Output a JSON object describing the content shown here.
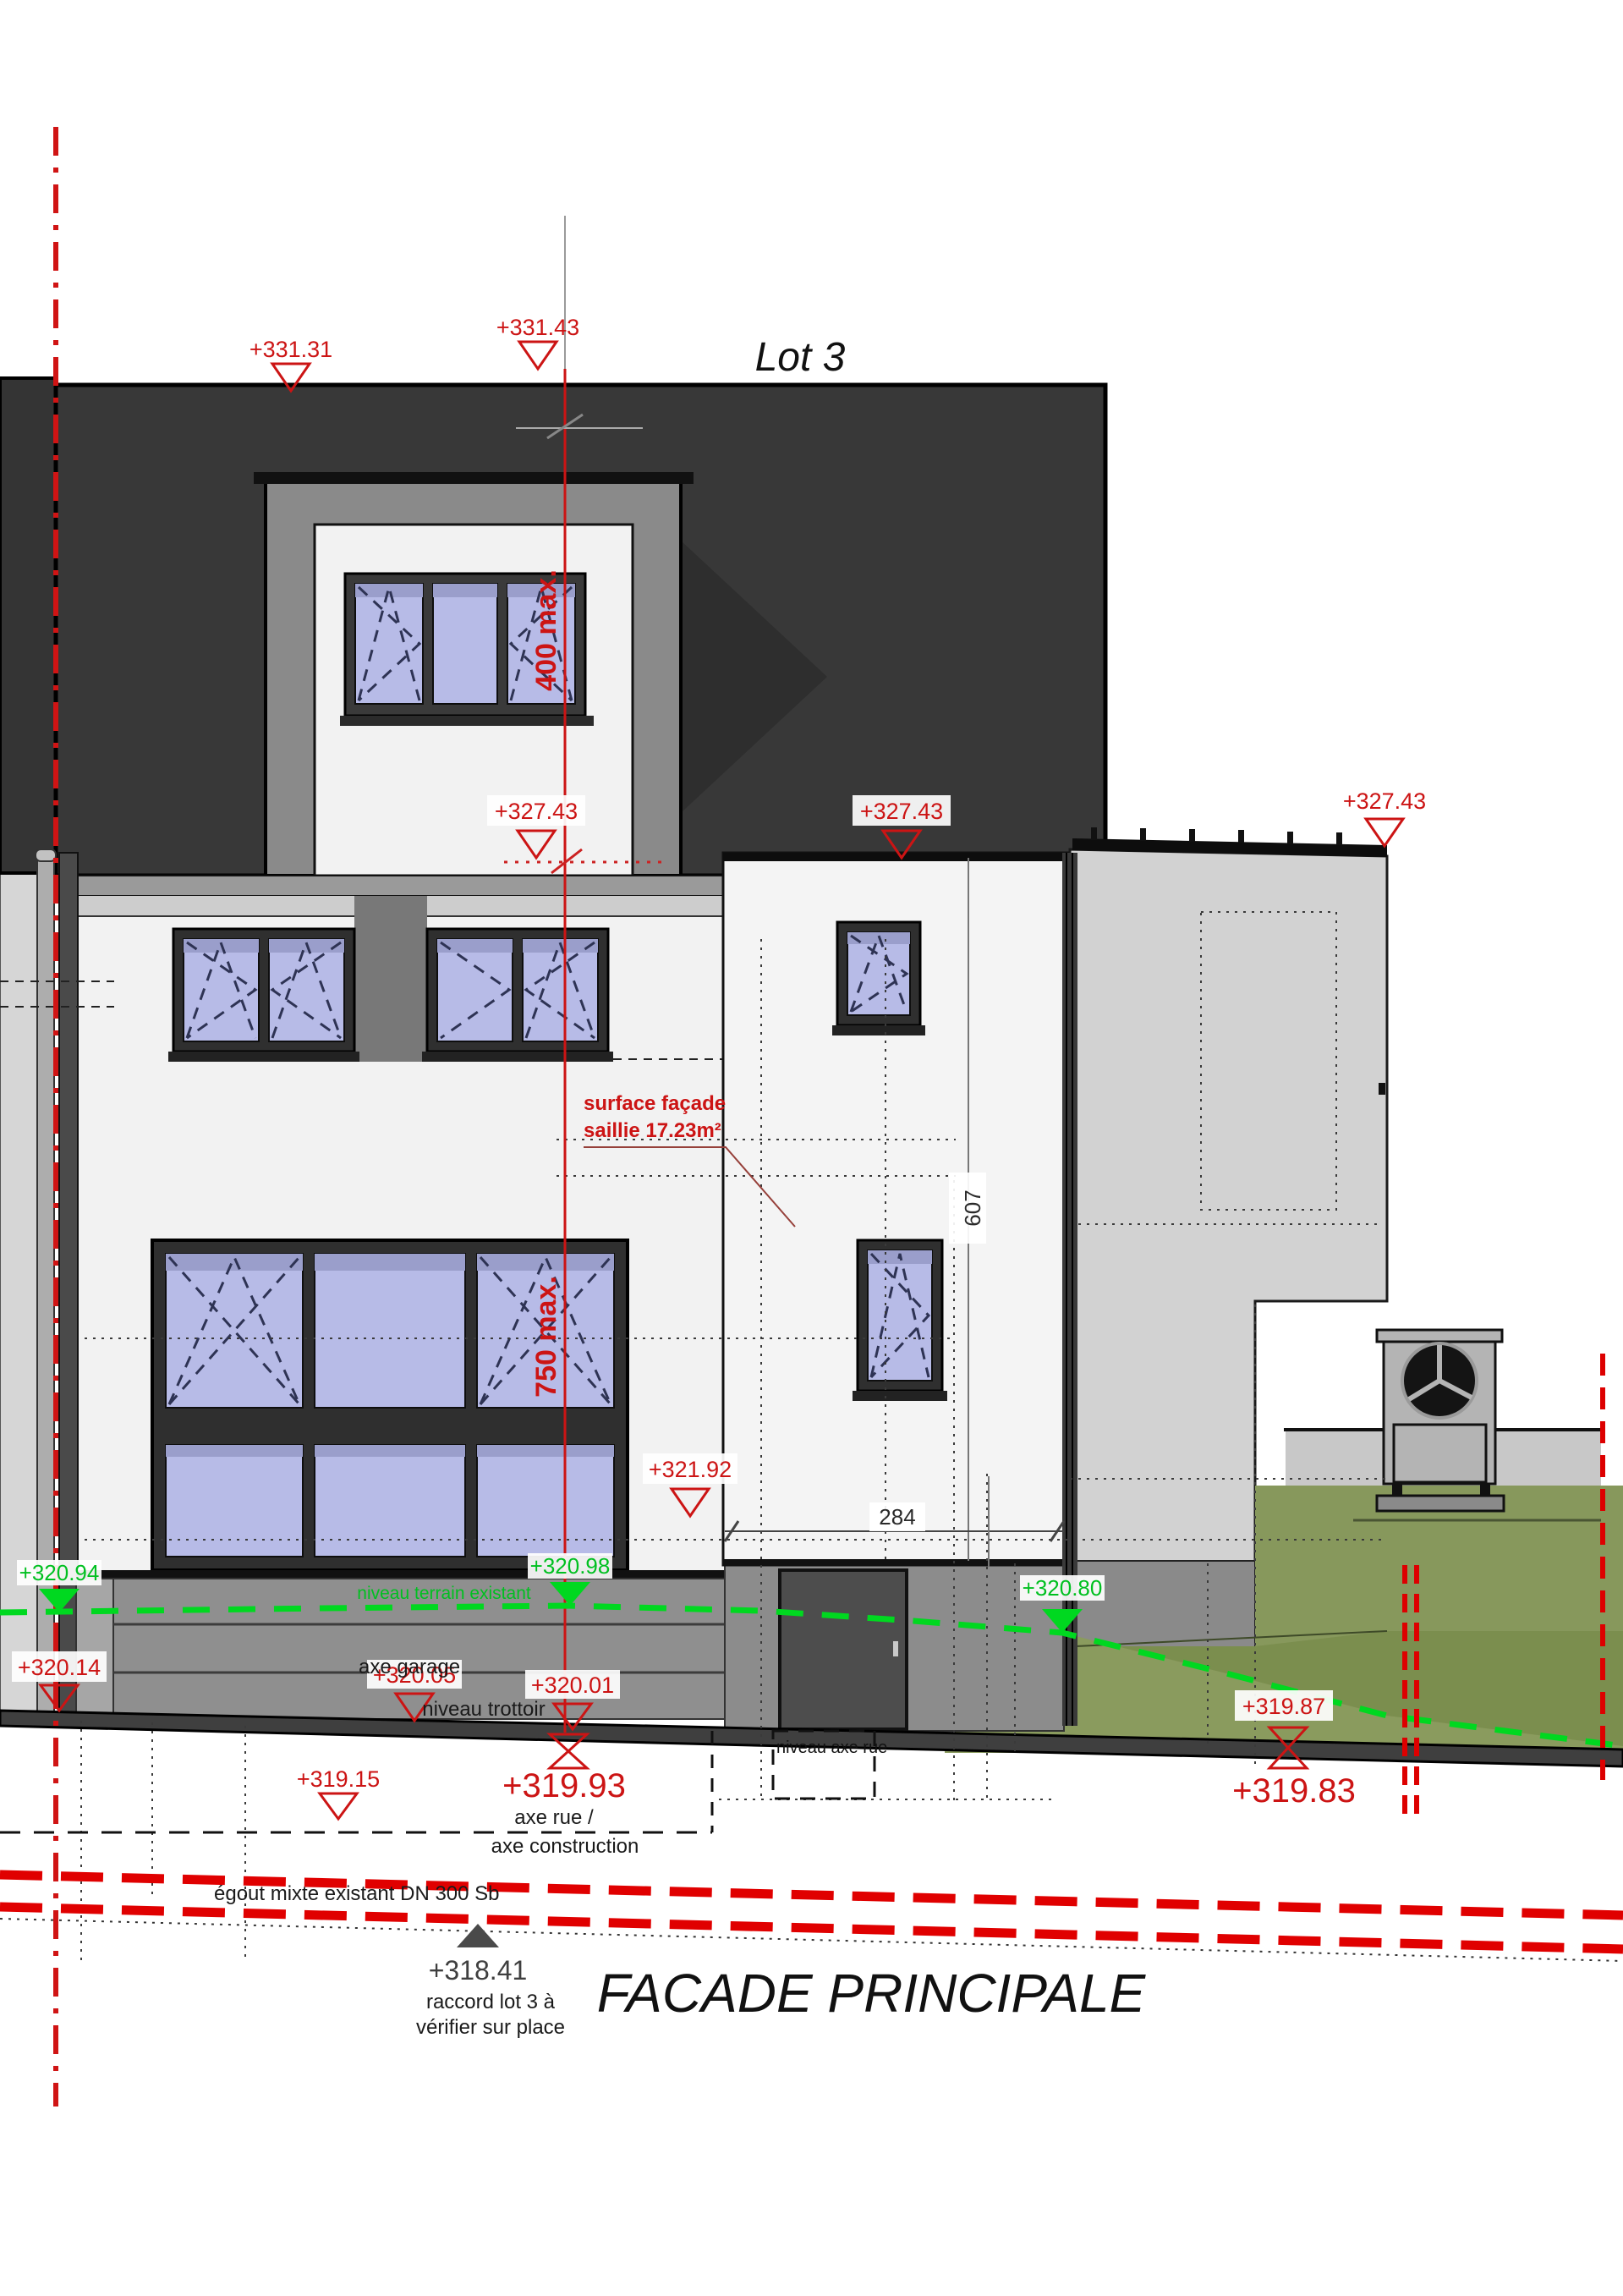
{
  "title": "Lot 3",
  "drawing_title": "FACADE PRINCIPALE",
  "levels": {
    "l331_31": "+331.31",
    "l331_43": "+331.43",
    "l327_43": "+327.43",
    "l321_92": "+321.92",
    "l320_94": "+320.94",
    "l320_98": "+320.98",
    "l320_80": "+320.80",
    "l320_14": "+320.14",
    "l320_05": "+320.05",
    "l320_01": "+320.01",
    "l319_87": "+319.87",
    "l319_15": "+319.15",
    "l319_93": "+319.93",
    "l319_83": "+319.83",
    "l318_41": "+318.41"
  },
  "dimensions": {
    "dormer_max": "400 max.",
    "window_max": "750 max.",
    "saillie_height": "607",
    "saillie_width": "284"
  },
  "notes": {
    "surface_line1": "surface façade",
    "surface_line2": "saillie 17.23m²",
    "terrain": "niveau terrain existant",
    "axe_garage": "axe garage",
    "trottoir": "niveau trottoir",
    "axe_rue_1": "axe rue /",
    "axe_rue_2": "axe construction",
    "niveau_axe_rue": "niveau axe rue",
    "egout": "égout mixte existant DN 300 Sb",
    "raccord_1": "raccord lot 3 à",
    "raccord_2": "vérifier sur place"
  },
  "colors": {
    "roof": "#383838",
    "facade": "#f2f2f2",
    "glass": "#b7bbe7",
    "terrain_line": "#00d820",
    "marker_red": "#cc1414",
    "sewer_red": "#e00000",
    "grass": "#7b8e4e",
    "lawn": "#87985c"
  }
}
